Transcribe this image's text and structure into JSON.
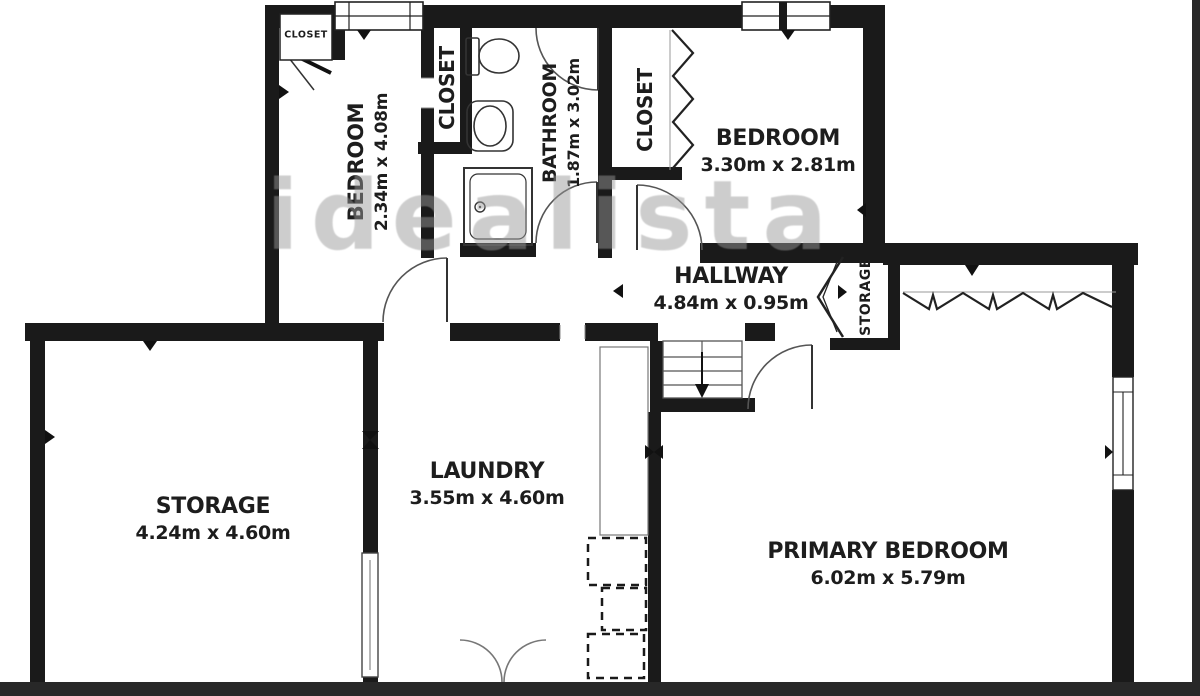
{
  "watermark": "idealista",
  "colors": {
    "wall": "#1a1a1a",
    "watermark": "#999999"
  },
  "rooms": {
    "bedroom_top_left": {
      "name": "BEDROOM",
      "dims": "2.34m x 4.08m"
    },
    "bedroom_top_right": {
      "name": "BEDROOM",
      "dims": "3.30m x 2.81m"
    },
    "bathroom": {
      "name": "BATHROOM",
      "dims": "1.87m x 3.02m"
    },
    "hallway": {
      "name": "HALLWAY",
      "dims": "4.84m x 0.95m"
    },
    "storage_room": {
      "name": "STORAGE",
      "dims": "4.24m x 4.60m"
    },
    "laundry": {
      "name": "LAUNDRY",
      "dims": "3.55m x 4.60m"
    },
    "primary_bedroom": {
      "name": "PRIMARY BEDROOM",
      "dims": "6.02m x 5.79m"
    },
    "closet_top_left": {
      "name": "CLOSET"
    },
    "closet_mid": {
      "name": "CLOSET"
    },
    "closet_top_right": {
      "name": "CLOSET"
    },
    "storage_closet": {
      "name": "STORAGE"
    }
  }
}
